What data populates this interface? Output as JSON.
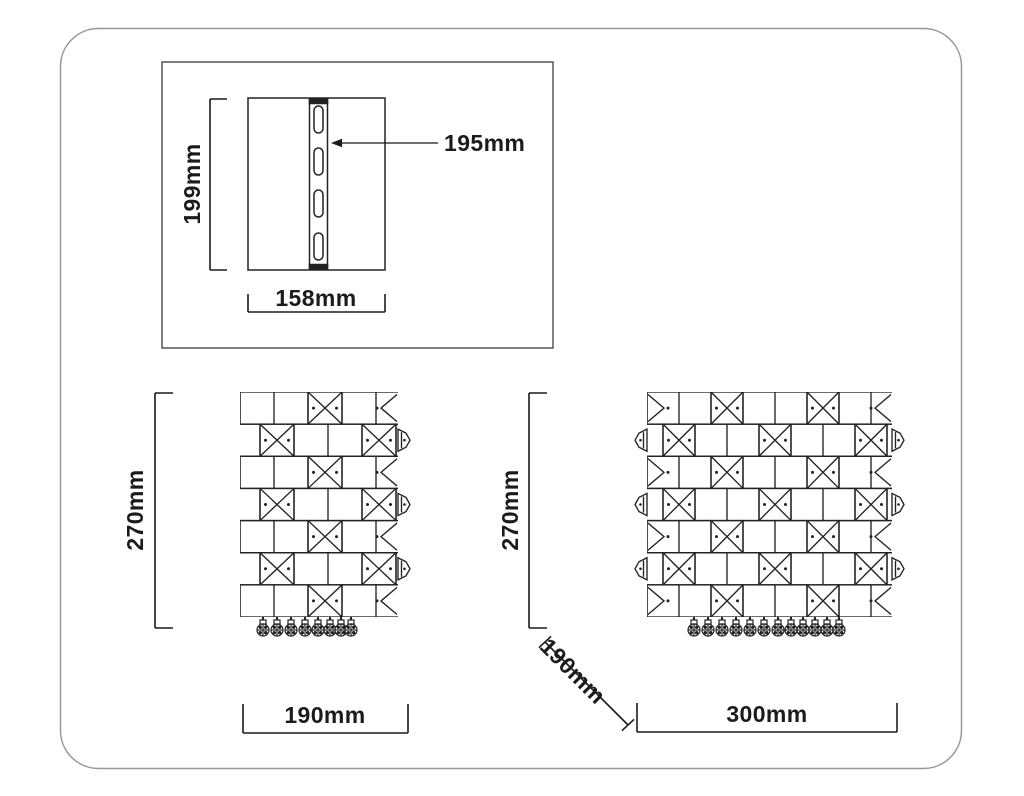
{
  "backplate_panel": {
    "height_label": "199mm",
    "width_label": "158mm",
    "bracket_label": "195mm"
  },
  "side_view": {
    "height_label": "270mm",
    "width_label": "190mm"
  },
  "front_view": {
    "height_label": "270mm",
    "depth_label": "190mm",
    "width_label": "300mm"
  },
  "colors": {
    "drawing_line": "#222226",
    "dimension_line": "#1b1b1b",
    "panel_border": "#3b3b3f",
    "frame_border": "#97979b",
    "background": "#ffffff"
  }
}
